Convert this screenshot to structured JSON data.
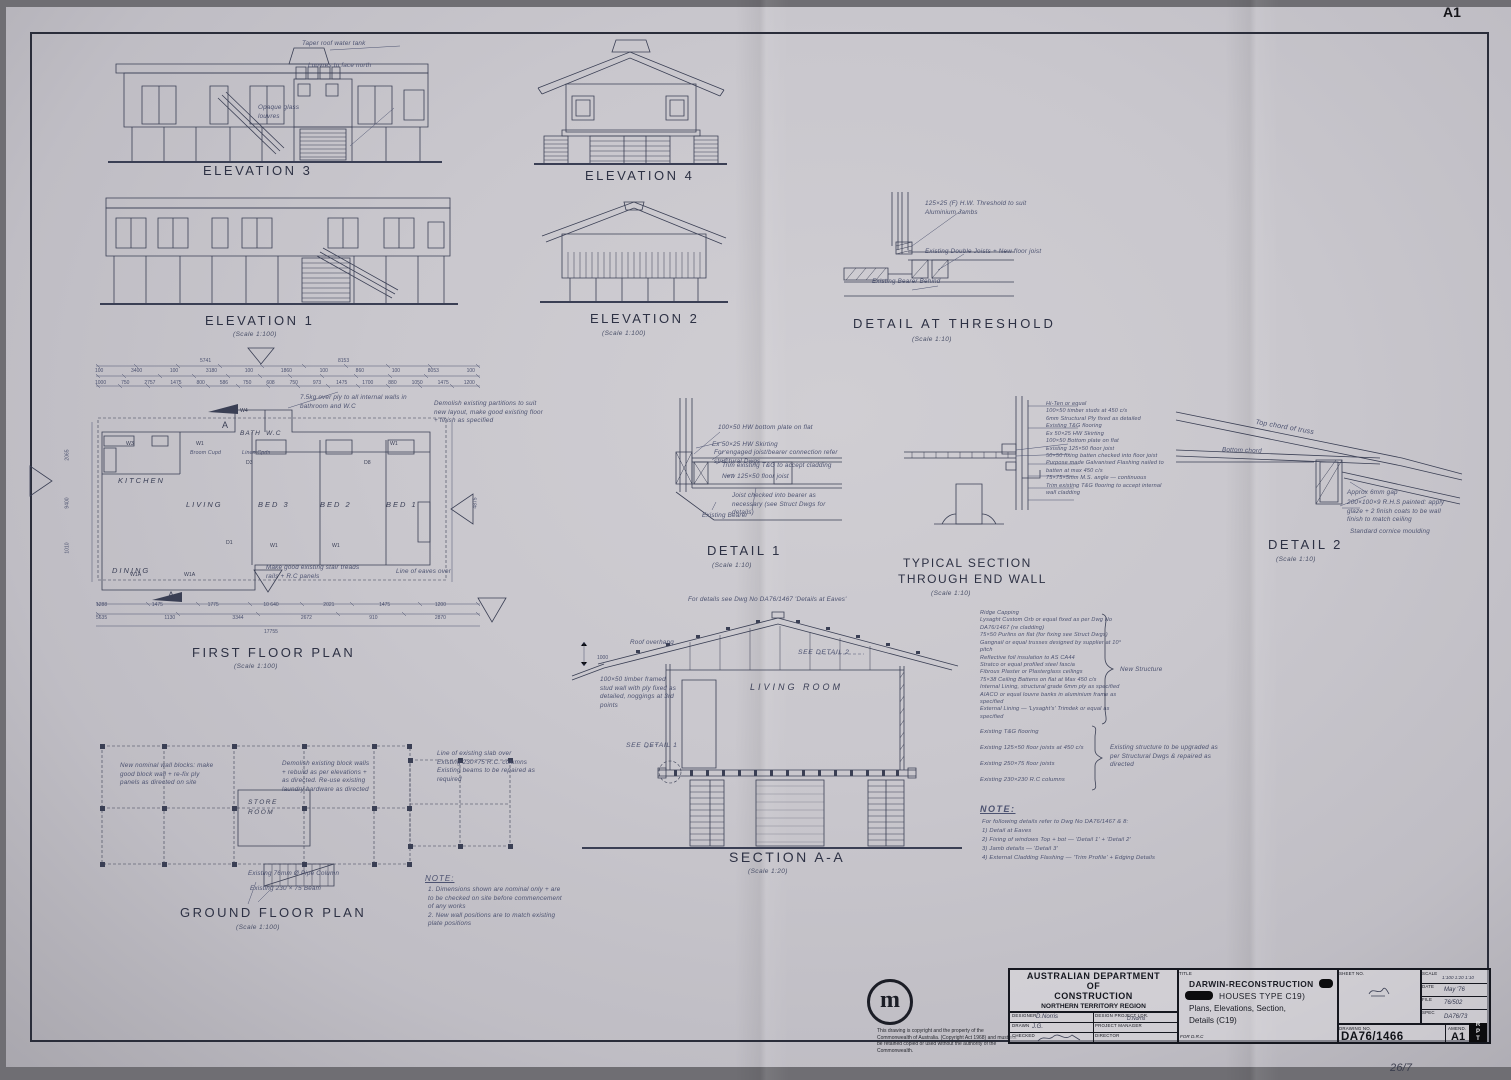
{
  "sheet": {
    "size_mark": "A1",
    "handwritten": "26/7"
  },
  "titles": {
    "elevation3": "ELEVATION 3",
    "elevation4": "ELEVATION 4",
    "elevation1": "ELEVATION 1",
    "elevation2": "ELEVATION 2",
    "threshold": "DETAIL AT THRESHOLD",
    "first_floor": "FIRST FLOOR PLAN",
    "ground_floor": "GROUND FLOOR PLAN",
    "detail1": "DETAIL 1",
    "detail2": "DETAIL 2",
    "typical1": "TYPICAL SECTION",
    "typical2": "THROUGH END WALL",
    "section": "SECTION A-A",
    "scale100": "(Scale 1:100)",
    "scale10": "(Scale 1:10)",
    "scale20": "(Scale 1:20)"
  },
  "el3": {
    "tank_note": "Taper roof water tank",
    "north_note": "Louvres to face north",
    "glass_note": "Opaque glass louvres"
  },
  "threshold_notes": [
    "125×25 (F) H.W. Threshold to suit Aluminium Jambs",
    "Existing Double Joists + New floor joist",
    "Existing Bearer Behind"
  ],
  "plan": {
    "rooms": {
      "kitchen": "KITCHEN",
      "living": "LIVING",
      "dining": "DINING",
      "bath": "BATH",
      "wc": "W.C",
      "bed3": "BED 3",
      "bed2": "BED 2",
      "bed1": "BED 1"
    },
    "tags": {
      "a": "A",
      "w1": "W1",
      "w1a": "W1A",
      "w3": "W3",
      "w4": "W4",
      "d1": "D1",
      "d3": "D3",
      "d8": "D8"
    },
    "notes": {
      "ply": "7.5kg over ply to all internal walls in bathroom and W.C",
      "linen": "Linen Cpds",
      "broom": "Broom Cupd",
      "stair": "Make good existing stair treads rails + R.C panels",
      "eaves": "Line of eaves over",
      "spec": "Demolish existing partitions to suit new layout, make good existing floor + finish as specified"
    },
    "dims_top1": [
      "5741",
      "8153"
    ],
    "dims_top2": [
      "100",
      "3400",
      "100",
      "3180",
      "100",
      "1860",
      "100",
      "860",
      "100",
      "8053",
      "100"
    ],
    "dims_top3": [
      "1000",
      "750",
      "2757",
      "1475",
      "800",
      "586",
      "750",
      "608",
      "750",
      "973",
      "1475",
      "1700",
      "880",
      "1050",
      "1475",
      "1200"
    ],
    "dims_bot1": [
      "1288",
      "1475",
      "1775",
      "10 640",
      "2021",
      "1475",
      "1200"
    ],
    "dims_bot2": [
      "5635",
      "1130",
      "3344",
      "2672",
      "910",
      "2870"
    ],
    "dims_total": "17755",
    "dims_side": [
      "2065",
      "9400",
      "1010",
      "4875"
    ]
  },
  "ground": {
    "store": "STORE ROOM",
    "pipe_col": "Existing 76mm Ø Pipe Column",
    "beam": "Existing 230 × 75 Beam",
    "demolish": "Demolish existing block walls + rebuild as per elevations + as directed. Re-use existing laundry hardware as directed",
    "left_note": "New nominal wall blocks: make good block wall + re-fix ply panels as directed on site",
    "right_notes": [
      "Line of existing slab over",
      "Existing 230×75 R.C. columns",
      "Existing beams to be repaired as required"
    ]
  },
  "detail1_notes": [
    "100×50 HW bottom plate on flat",
    "Ex 50×25 HW Skirting",
    "For engaged joist/bearer connection refer structural Dwgs",
    "Trim existing T&G to accept cladding",
    "New 125×50 floor joist",
    "Joist checked into bearer as necessary (see Struct Dwgs for details)",
    "Existing Bearer"
  ],
  "typical_notes": [
    "Hi-Ten or equal",
    "100×50 timber studs at 450 c/s",
    "6mm Structural Ply fixed as detailed",
    "Existing T&G flooring",
    "Ex 50×25 HW Skirting",
    "100×50 Bottom plate on flat",
    "Existing 125×50 floor joist",
    "50×50 fixing batten checked into floor joist",
    "Purpose made Galvanised Flashing nailed to batten at max 450 c/s",
    "75×75×5mm M.S. angle — continuous",
    "Trim existing T&G flooring to accept internal wall cladding"
  ],
  "detail2_notes": {
    "top_chord": "Top chord of truss",
    "bottom_chord": "Bottom chord",
    "gap": "Approx 6mm gap",
    "rhs": "200×100×9 R.H.S painted: apply glaze + 2 finish coats to be wall finish to match ceiling",
    "cornice": "Standard cornice moulding"
  },
  "section": {
    "room": "LIVING ROOM",
    "roof_overhang": "Roof overhang",
    "dim": "1000",
    "see_detail1": "SEE DETAIL 1",
    "see_detail2": "SEE DETAIL 2",
    "top_note": "For details see Dwg No DA76/1467 'Details at Eaves'",
    "wall_note": "100×50 timber framed stud wall with ply fixed as detailed, noggings at 3rd points"
  },
  "section_lists": {
    "new_label": "New Structure",
    "new_structure": [
      "Ridge Capping",
      "Lysaght Custom Orb or equal fixed as per Dwg No DA76/1467 (re cladding)",
      "75×50 Purlins on flat (for fixing see Struct Dwgs)",
      "Gangnail or equal trusses designed by supplier at 10° pitch",
      "Reflective foil insulation to AS CA44",
      "Stratco or equal profiled steel fascia",
      "Fibrous Plaster or Plasterglass ceilings",
      "75×38 Ceiling Battens on flat at Max 450 c/s",
      "Internal Lining, structural grade 6mm ply as specified",
      "AIACO or equal louvre banks in aluminium frame as specified",
      "External Lining — 'Lysaght's' Trimdek or equal as specified"
    ],
    "existing_label": "Existing structure to be upgraded as per Structural Dwgs & repaired as directed",
    "existing": [
      "Existing T&G flooring",
      "Existing 125×50 floor joists at 450 c/s",
      "Existing 250×75 floor joists",
      "Existing 230×230 R.C columns"
    ]
  },
  "note_right": {
    "title": "NOTE:",
    "lines": [
      "For following details refer to Dwg No DA76/1467 & 8:",
      "1)  Detail at Eaves",
      "2)  Fixing of windows Top + bot — 'Detail 1' + 'Detail 2'",
      "3)  Jamb details — 'Detail 3'",
      "4)  External Cladding Flashing — 'Trim Profile' + Edging Details"
    ]
  },
  "note_mid": {
    "title": "NOTE:",
    "lines": [
      "1. Dimensions shown are nominal only + are to be checked on site before commencement of any works",
      "2. New wall positions are to match existing plate positions"
    ]
  },
  "title_block": {
    "dept": [
      "AUSTRALIAN  DEPARTMENT",
      "OF",
      "CONSTRUCTION"
    ],
    "region": "NORTHERN   TERRITORY   REGION",
    "logo_letter": "m",
    "designer_label": "DESIGNER",
    "designer": "D.Norris",
    "dpl_label": "DESIGN PROJECT LDR.",
    "dpl": "D.Norris",
    "drawn_label": "DRAWN",
    "drawn": "J.G.",
    "pm_label": "PROJECT MANAGER",
    "pm": "",
    "checked_label": "CHECKED",
    "checked": "",
    "director_label": "DIRECTOR",
    "director": "",
    "title_label": "TITLE",
    "title_line1": "DARWIN-RECONSTRUCTION",
    "title_line2": "HOUSES  TYPE  C19)",
    "title_line3": "Plans, Elevations, Section,",
    "title_line4": "Details (C19)",
    "for_note": "FOR  D.R.C",
    "sheet_no_label": "SHEET NO.",
    "scale_label": "SCALE",
    "scale": "1:100  1:20  1:10",
    "date_label": "DATE",
    "date": "May '76",
    "file_label": "FILE",
    "file": "76/502",
    "spec_label": "SPEC",
    "spec": "DA76/73",
    "drawing_no_label": "DRAWING NO.",
    "drawing_no": "DA76/1466",
    "amend_label": "AMEND.",
    "amend": "A1",
    "rpt": "RPT"
  },
  "copyright": "This drawing is copyright and the property of the Commonwealth of Australia. (Copyright Act 1968) and must not be retained copied or used without the authority of the Commonwealth."
}
